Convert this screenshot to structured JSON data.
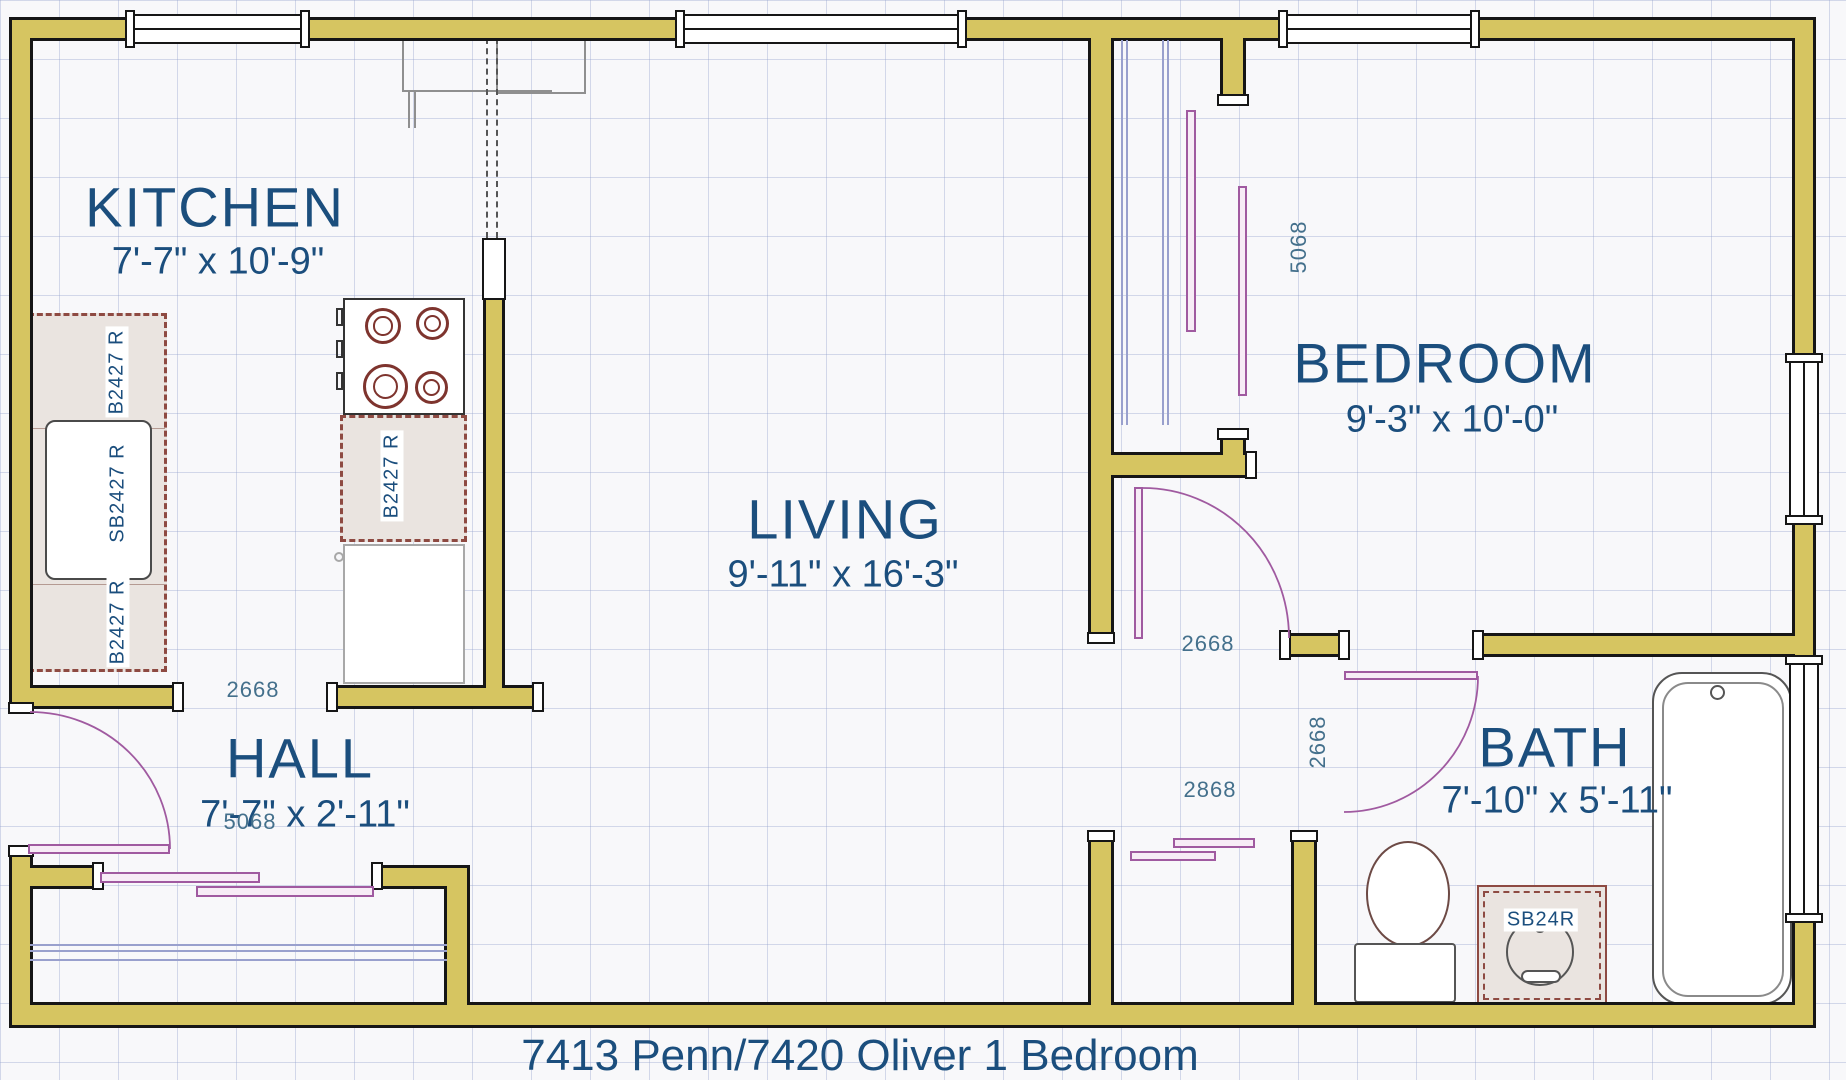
{
  "title": "7413 Penn/7420 Oliver 1 Bedroom",
  "rooms": {
    "kitchen": {
      "name": "KITCHEN",
      "dims": "7'-7\" x 10'-9\""
    },
    "living": {
      "name": "LIVING",
      "dims": "9'-11\" x 16'-3\""
    },
    "bedroom": {
      "name": "BEDROOM",
      "dims": "9'-3\" x 10'-0\""
    },
    "hall": {
      "name": "HALL",
      "dims": "7'-7\" x 2'-11\""
    },
    "bath": {
      "name": "BATH",
      "dims": "7'-10\" x 5'-11\""
    }
  },
  "door_size_labels": {
    "hall_opening": "2668",
    "hall_closet_bypass": "5068",
    "bedroom_door": "2668",
    "bedroom_closet_bypass": "5068",
    "bath_door": "2668",
    "living_closet_bypass": "2868"
  },
  "cabinet_labels": {
    "counter_upper": "B2427 R",
    "sink_base": "SB2427 R",
    "counter_lower": "B2427 R",
    "stove_base": "B2427 R",
    "bath_vanity": "SB24R"
  },
  "colors": {
    "wall": "#d6c561",
    "room_label": "#1b4e7d",
    "dimension_label": "#44708c",
    "door_swing": "#a05aa0"
  }
}
